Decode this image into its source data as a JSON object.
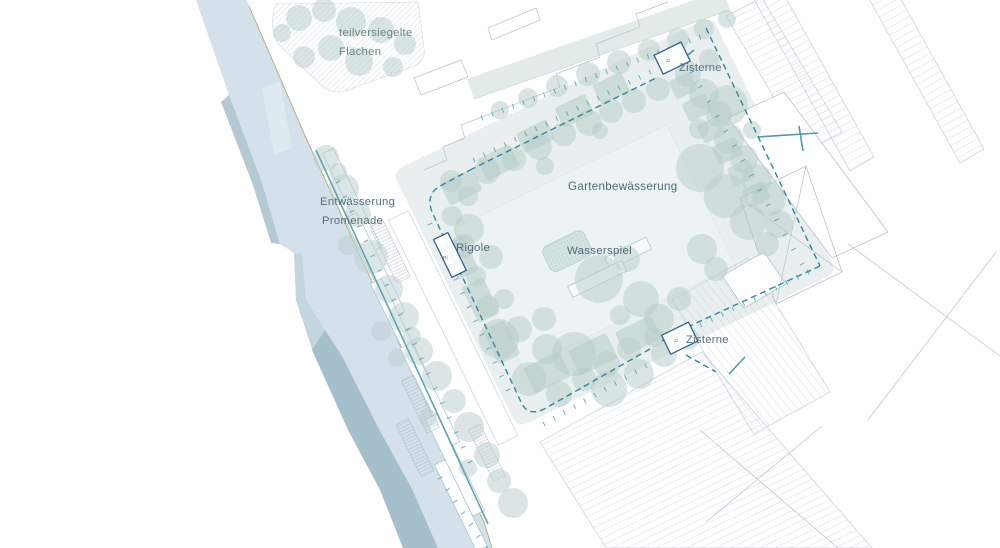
{
  "plan": {
    "labels": [
      {
        "id": "partially-sealed-line1",
        "text": "teilversiegelte",
        "x": 339,
        "y": 36,
        "size": 11.3,
        "color": "#6d8784"
      },
      {
        "id": "partially-sealed-line2",
        "text": "Flächen",
        "x": 339,
        "y": 55,
        "size": 11.3,
        "color": "#6d8784"
      },
      {
        "id": "cistern-top",
        "text": "Zisterne",
        "x": 679,
        "y": 71,
        "size": 11.2,
        "color": "#53707e"
      },
      {
        "id": "garden-irrigation",
        "text": "Gartenbewässerung",
        "x": 568,
        "y": 190,
        "size": 11.6,
        "color": "#4f6b78"
      },
      {
        "id": "drainage-line1",
        "text": "Entwässerung",
        "x": 320,
        "y": 205,
        "size": 11.3,
        "color": "#55707a"
      },
      {
        "id": "drainage-line2",
        "text": "Promenade",
        "x": 322,
        "y": 224,
        "size": 11.3,
        "color": "#55707a"
      },
      {
        "id": "infiltration-trench",
        "text": "Rigole",
        "x": 456,
        "y": 251,
        "size": 11.4,
        "color": "#4f6b78"
      },
      {
        "id": "water-feature",
        "text": "Wasserspiel",
        "x": 567,
        "y": 254,
        "size": 11.4,
        "color": "#4f6b78"
      },
      {
        "id": "cistern-bottom",
        "text": "Zisterne",
        "x": 686,
        "y": 343,
        "size": 11.2,
        "color": "#53707e"
      }
    ],
    "tiny_labels": [
      {
        "id": "cistern-top-code",
        "text": "Zi",
        "x": 666,
        "y": 62
      },
      {
        "id": "cistern-bottom-code",
        "text": "Zi",
        "x": 674,
        "y": 342
      },
      {
        "id": "rigole-code",
        "text": "Ri",
        "x": 443,
        "y": 259
      }
    ]
  },
  "colors": {
    "water": "#d4e1ea",
    "facet": "#a6c0cb",
    "facet_mid": "#c3d5de",
    "pier": "#e6eef3",
    "garden": "#e8efee",
    "field": "#edf3f2",
    "strip": "#e2ebe8",
    "bed": "#c0d4d0",
    "tree1": "#b6ccc8",
    "tree2": "#bdcfd1",
    "hatch": "#c2d1da",
    "hatch_dense": "#b8cbd3",
    "outline": "#aabfc9",
    "dash": "#2b8a9d",
    "solid": "#4e9aa7",
    "channel": "#58a2ad",
    "olive": "#a9b77d",
    "navy": "#36608c",
    "tick": "#4e9aa8",
    "label": "#54707c",
    "wasserspiel": "#d3e2e2",
    "ladder": "#9db3ba",
    "walk": "#c6d6d3",
    "platform": "#fdfefe"
  },
  "geometry": {
    "rot": {
      "angle": -26,
      "cx": 540,
      "cy": 280
    },
    "river": {
      "water": "196,0 247,0 258,28 306,138 352,238 374,286 410,368 452,458 483,520 492,548 404,548 381,490 349,430 313,352 296,300 294,253 280,244 261,180 229,95",
      "facet_bottom": "312,350 348,430 380,490 403,548 438,548 412,489 379,429 342,356 325,330",
      "facet_top": "229,95 261,180 280,244 271,243 253,185 221,102",
      "facet_mid": "294,253 296,300 313,352 325,330 306,300 302,254",
      "pier": "262,88 280,82 292,148 274,154",
      "olive": "249,6 306,138 352,238 374,286 410,368 452,458 484,522 492,548"
    },
    "north_strip": {
      "pts": "474,99 730,10 723,-10 467,79",
      "edge": "474,99 730,10"
    },
    "partially_sealed": {
      "path": "M276,4 Q268,26 278,44 L320,84 Q332,96 348,90 L414,66 Q426,61 424,48 L418,2 Z"
    },
    "buildings": {
      "hatched": [
        {
          "pts": "747,-13 772,-27 874,157 850,171",
          "pattern": "hatchC"
        },
        {
          "pts": "868,-3 892,-17 984,149 960,163",
          "pattern": "hatchC"
        },
        {
          "pts": "726,16 762,-2 842,132 806,152",
          "pattern": "hatchA"
        },
        {
          "pts": "540,442 702,352 872,548 606,548",
          "pattern": "hatchA"
        },
        {
          "pts": "672,300 748,258 830,392 754,434",
          "pattern": "hatchD"
        }
      ],
      "outlined": [
        {
          "pts": "728,118 784,92 888,232 832,258",
          "fill": "#ffffff"
        },
        {
          "pts": "740,198 806,166 842,272 776,304",
          "fill": "none"
        },
        {
          "pts": "722,276 764,252 786,284 744,308",
          "fill": "#ffffff"
        }
      ],
      "lines": [
        "M424,170 L447,160 L443,147 L465,138 L461,125 L487,115",
        "M487,115 L560,87 L556,74 L600,57",
        "M600,57 L596,44 L640,27 L636,14 L668,2",
        "M421,95 L468,77 L461,60 L414,78 Z",
        "M492,40 L540,20 L536,8 L488,28 Z",
        "M740,198 L842,272",
        "M806,166 L776,304",
        "M848,244 L1000,356",
        "M996,252 L868,420",
        "M700,430 L838,548",
        "M822,426 L706,522"
      ]
    },
    "garden": {
      "base": [
        455,
        118,
        355,
        285
      ],
      "field": [
        486,
        196,
        236,
        156
      ],
      "walk": [
        430,
        160,
        22,
        250
      ],
      "beds": [
        [
          492,
          150,
          36,
          24
        ],
        [
          536,
          144,
          36,
          24
        ],
        [
          582,
          138,
          34,
          22
        ],
        [
          628,
          132,
          34,
          22
        ],
        [
          672,
          128,
          32,
          22
        ],
        [
          742,
          158,
          24,
          20
        ],
        [
          744,
          184,
          26,
          20
        ],
        [
          748,
          210,
          24,
          20
        ],
        [
          752,
          236,
          26,
          20
        ],
        [
          756,
          262,
          24,
          20
        ],
        [
          760,
          288,
          24,
          20
        ],
        [
          466,
          206,
          24,
          38
        ],
        [
          466,
          252,
          24,
          40
        ],
        [
          466,
          300,
          24,
          38
        ],
        [
          486,
          352,
          40,
          28
        ],
        [
          534,
          356,
          42,
          28
        ],
        [
          584,
          360,
          40,
          26
        ]
      ],
      "wasserspiel_rect": [
        554,
        252,
        46,
        28
      ],
      "structures": [
        [
          608,
          288,
          46,
          13
        ],
        [
          562,
          298,
          60,
          12
        ]
      ]
    },
    "promenade": {
      "platforms": [
        [
          400,
          71,
          12,
          110
        ],
        [
          391,
          139,
          14,
          110
        ],
        [
          386,
          209,
          12,
          110
        ],
        [
          384,
          280,
          13,
          110
        ],
        [
          376,
          355,
          13,
          108
        ],
        [
          364,
          400,
          12,
          96
        ]
      ],
      "ladders": [
        [
          410,
          158,
          15,
          62
        ],
        [
          371,
          310,
          14,
          58
        ],
        [
          347,
          347,
          14,
          58
        ],
        [
          410,
          383,
          13,
          58
        ]
      ],
      "channel": "M316,150 L488,524"
    },
    "markers": {
      "rigole_rect": [
        462,
        197,
        16,
        42
      ],
      "cistern_top_rect": [
        741,
        128,
        30,
        21
      ],
      "cistern_bottom_rect": [
        625,
        383,
        30,
        21
      ]
    },
    "dashes": [
      "M470,170 L658,77",
      "M706,28 L820,266",
      "M820,266 L694,324 L662,341",
      "M650,349 L546,408 Q528,418 521,402 L432,212 Q425,193 442,185 L470,170",
      "M686,355 L716,372"
    ],
    "solids": [
      "M758,137 L818,133",
      "M799,126 L803,151",
      "M683,59 L694,50",
      "M729,374 L745,357"
    ],
    "ticks": [
      [
        482,
        118,
        700,
        37,
        22
      ],
      [
        474,
        160,
        650,
        72,
        18
      ],
      [
        430,
        224,
        508,
        390,
        13
      ],
      [
        338,
        182,
        470,
        462,
        20
      ],
      [
        544,
        424,
        646,
        366,
        11
      ],
      [
        690,
        330,
        808,
        272,
        12
      ],
      [
        692,
        72,
        802,
        264,
        14
      ],
      [
        440,
        478,
        486,
        548,
        7
      ]
    ],
    "trees": {
      "tone1": [
        [
          299,
          18,
          13
        ],
        [
          324,
          10,
          12
        ],
        [
          351,
          22,
          15
        ],
        [
          381,
          30,
          13
        ],
        [
          405,
          44,
          11
        ],
        [
          331,
          48,
          13
        ],
        [
          304,
          57,
          11
        ],
        [
          359,
          62,
          14
        ],
        [
          393,
          67,
          10
        ],
        [
          282,
          33,
          9
        ],
        [
          500,
          110,
          9
        ],
        [
          528,
          98,
          10
        ],
        [
          557,
          86,
          11
        ],
        [
          588,
          74,
          12
        ],
        [
          619,
          62,
          12
        ],
        [
          649,
          50,
          11
        ],
        [
          678,
          39,
          11
        ],
        [
          704,
          29,
          10
        ],
        [
          727,
          19,
          9
        ],
        [
          451,
          181,
          11
        ],
        [
          468,
          196,
          10
        ],
        [
          487,
          171,
          13
        ],
        [
          514,
          159,
          12
        ],
        [
          539,
          147,
          13
        ],
        [
          564,
          134,
          12
        ],
        [
          589,
          123,
          13
        ],
        [
          611,
          111,
          12
        ],
        [
          634,
          101,
          12
        ],
        [
          658,
          89,
          12
        ],
        [
          545,
          166,
          9
        ],
        [
          600,
          131,
          8
        ],
        [
          688,
          74,
          13
        ],
        [
          704,
          94,
          15
        ],
        [
          719,
          114,
          13
        ],
        [
          699,
          129,
          10
        ],
        [
          729,
          139,
          15
        ],
        [
          744,
          159,
          14
        ],
        [
          757,
          179,
          15
        ],
        [
          709,
          59,
          10
        ],
        [
          769,
          199,
          17
        ],
        [
          779,
          224,
          14
        ],
        [
          767,
          244,
          12
        ],
        [
          752,
          130,
          9
        ],
        [
          728,
          105,
          20
        ],
        [
          700,
          168,
          24
        ],
        [
          726,
          196,
          22
        ],
        [
          748,
          222,
          18
        ],
        [
          469,
          229,
          15
        ],
        [
          491,
          257,
          12
        ],
        [
          504,
          299,
          10
        ],
        [
          519,
          329,
          13
        ],
        [
          547,
          349,
          15
        ],
        [
          499,
          339,
          20
        ],
        [
          529,
          379,
          17
        ],
        [
          559,
          394,
          13
        ],
        [
          584,
          379,
          12
        ],
        [
          607,
          364,
          13
        ],
        [
          629,
          349,
          12
        ],
        [
          654,
          337,
          10
        ],
        [
          609,
          389,
          18
        ],
        [
          639,
          374,
          15
        ],
        [
          664,
          354,
          13
        ],
        [
          688,
          339,
          11
        ],
        [
          574,
          354,
          22
        ],
        [
          544,
          319,
          12
        ],
        [
          599,
          279,
          24
        ],
        [
          627,
          259,
          13
        ],
        [
          641,
          299,
          18
        ],
        [
          659,
          319,
          15
        ],
        [
          679,
          299,
          12
        ],
        [
          620,
          315,
          10
        ],
        [
          702,
          249,
          15
        ],
        [
          716,
          269,
          12
        ],
        [
          452,
          216,
          10
        ],
        [
          463,
          246,
          12
        ],
        [
          476,
          276,
          10
        ],
        [
          488,
          306,
          11
        ]
      ],
      "tone2": [
        [
          326,
          158,
          13
        ],
        [
          344,
          189,
          15
        ],
        [
          358,
          214,
          13
        ],
        [
          348,
          245,
          10
        ],
        [
          371,
          257,
          17
        ],
        [
          389,
          289,
          14
        ],
        [
          404,
          317,
          15
        ],
        [
          381,
          331,
          10
        ],
        [
          419,
          351,
          14
        ],
        [
          437,
          376,
          15
        ],
        [
          454,
          401,
          12
        ],
        [
          469,
          427,
          15
        ],
        [
          487,
          455,
          13
        ],
        [
          499,
          481,
          12
        ],
        [
          513,
          503,
          15
        ],
        [
          468,
          468,
          9
        ],
        [
          428,
          418,
          9
        ],
        [
          397,
          358,
          9
        ],
        [
          338,
          172,
          9
        ],
        [
          412,
          336,
          9
        ]
      ]
    }
  }
}
